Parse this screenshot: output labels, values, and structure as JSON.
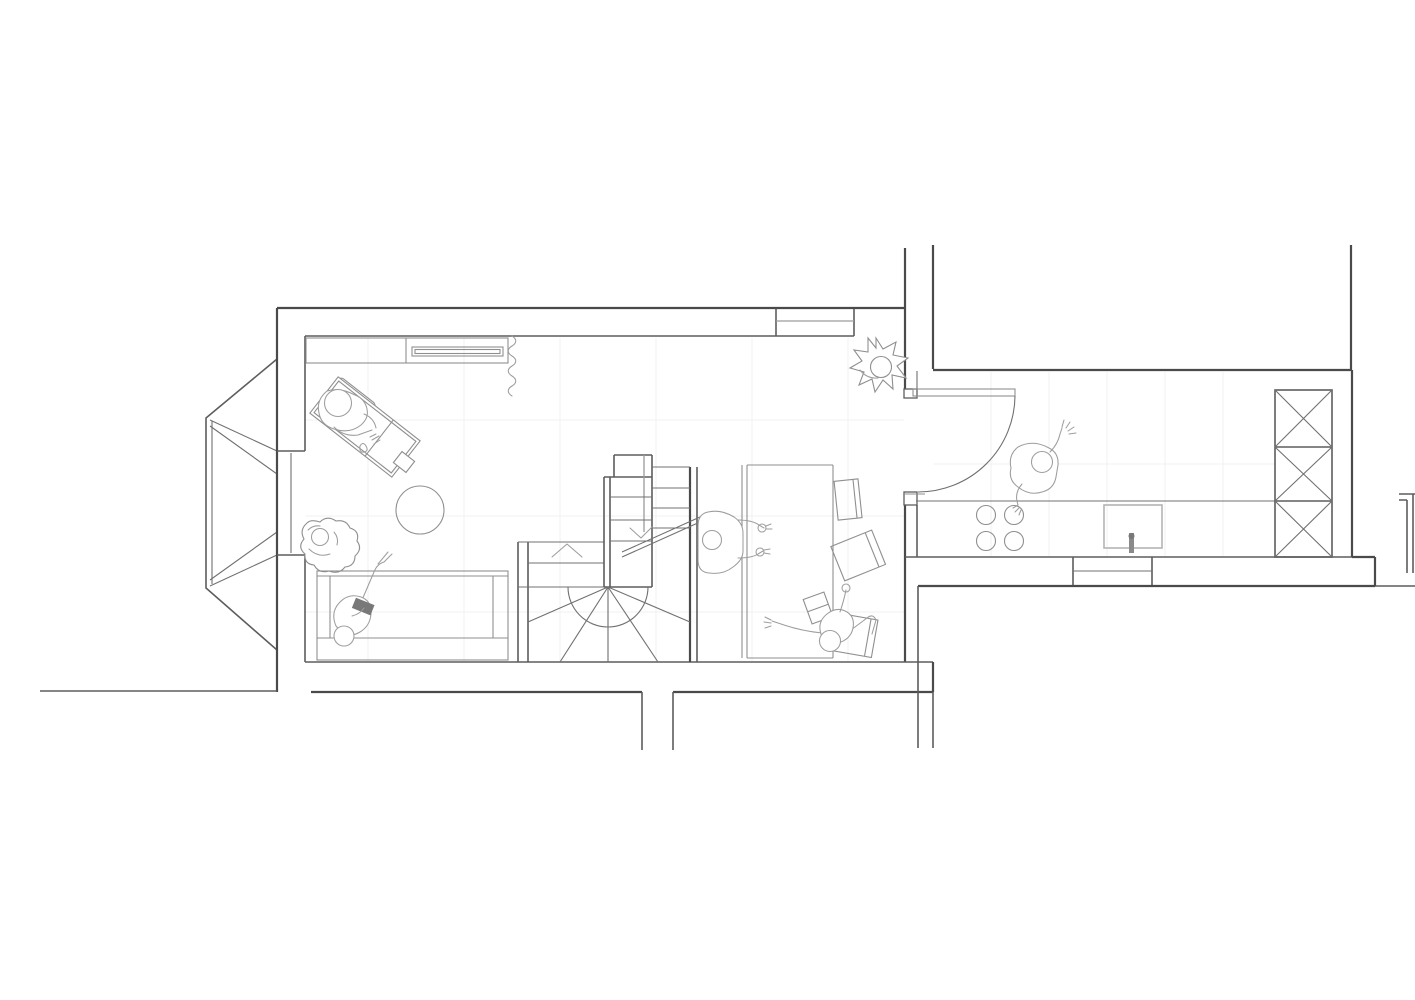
{
  "plan": {
    "aria_label": "Black and white architectural floor plan, top view line drawing of a small apartment",
    "rooms": [
      {
        "name": "living-area"
      },
      {
        "name": "dining-nook"
      },
      {
        "name": "stair-core"
      },
      {
        "name": "kitchen"
      },
      {
        "name": "dormer-bay"
      }
    ],
    "furniture": [
      "wall-shelf-unit",
      "desk",
      "desk-chair",
      "stool",
      "round-rug",
      "armchair",
      "sofa",
      "winder-staircase",
      "ladder-shelf",
      "dining-table",
      "bench",
      "dining-chair",
      "kitchen-counter",
      "hob",
      "sink",
      "tall-x-braced-cabinets"
    ],
    "people": [
      "person-at-desk",
      "person-in-armchair",
      "person-on-sofa",
      "person-at-table",
      "person-lounging",
      "person-in-kitchen"
    ],
    "symbols": [
      "door-swing-arc",
      "window-glazing",
      "curtain-squiggle",
      "potted-plant",
      "stair-direction-arrow",
      "floor-tile-grid"
    ]
  },
  "palette": {
    "background": "#ffffff",
    "wall_line": "#4a4a4a",
    "wall_line_light": "#5d5d5d",
    "thin_line": "#707070",
    "furniture_line": "#8f8f8f",
    "person_line": "#9d9d9d",
    "tile_line": "#f0f0f0",
    "sink_line": "#b4b4b4",
    "book_fill": "#787878"
  }
}
